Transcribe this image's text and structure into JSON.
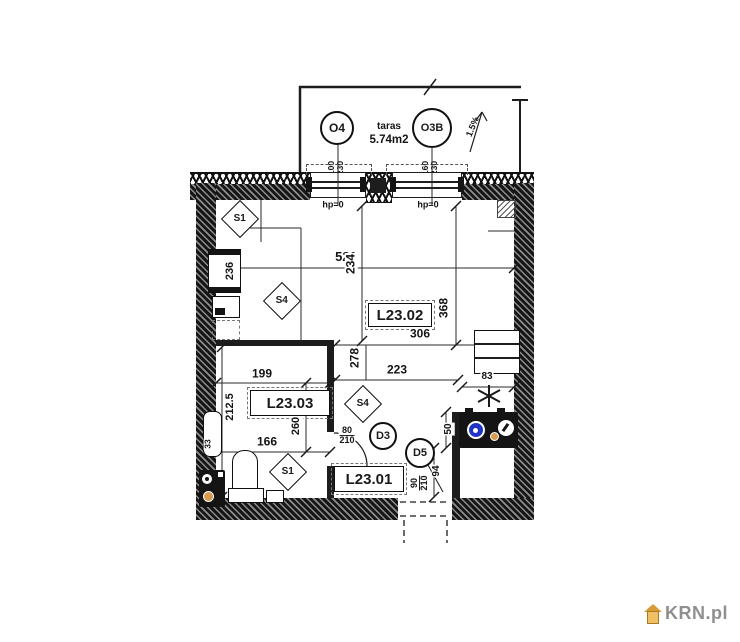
{
  "colors": {
    "ink": "#1a1a1a",
    "stove_burner_blue": "#2233c8",
    "knob_orange": "#d89a4e",
    "watermark_gray": "#8f8f8f",
    "watermark_orange": "#e8a33d"
  },
  "watermark": {
    "brand": "KRN.pl"
  },
  "terrace": {
    "name": "taras",
    "area": "5.74m2",
    "slope": "1.5%",
    "windows": [
      {
        "id": "O4",
        "width": "100",
        "height": "230",
        "header_note": "hp=0"
      },
      {
        "id": "O3B",
        "width": "160",
        "height": "230",
        "header_note": "hp=0"
      }
    ]
  },
  "rooms": {
    "living": "L23.02",
    "bathroom": "L23.03",
    "hall": "L23.01"
  },
  "doors": {
    "d3": {
      "id": "D3",
      "width": "80",
      "height": "210"
    },
    "d5": {
      "id": "D5",
      "width": "90",
      "height": "210"
    }
  },
  "symbols": {
    "s1": "S1",
    "s4": "S4"
  },
  "dims": {
    "d521": "521",
    "d234": "234",
    "d368": "368",
    "d306": "306",
    "d223": "223",
    "d278": "278",
    "d199": "199",
    "d212_5": "212.5",
    "d260": "260",
    "d166": "166",
    "d236": "236",
    "d33": "33",
    "d83": "83",
    "d50": "50",
    "d94": "94"
  }
}
